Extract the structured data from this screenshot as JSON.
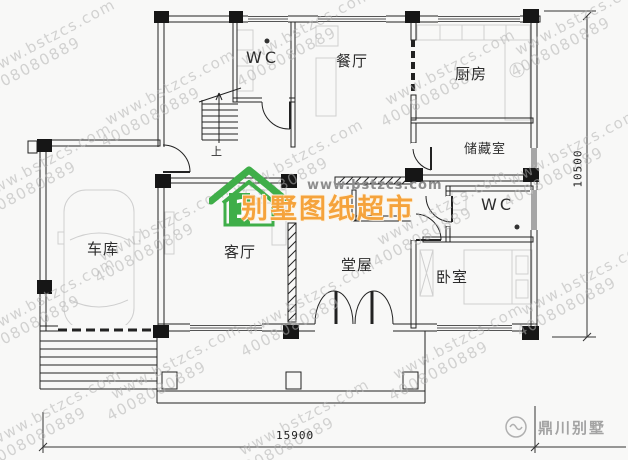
{
  "watermark": {
    "site": "www.bstzcs.com",
    "phone": "4008080889"
  },
  "rooms": {
    "wc_top": "WC",
    "dining": "餐厅",
    "kitchen": "厨房",
    "storage": "储藏室",
    "wc_right": "WC",
    "garage": "车库",
    "living": "客厅",
    "hall": "堂屋",
    "bedroom": "卧室"
  },
  "stairs": {
    "up_label": "上"
  },
  "dimensions": {
    "width_label": "15900",
    "height_label": "10500"
  },
  "center_logo": {
    "site": "www.bstzcs.com",
    "title": "别墅图纸超市",
    "house_number": "1"
  },
  "corner_logo": {
    "name": "鼎川别墅"
  },
  "colors": {
    "line": "#1f1f1f",
    "accent_green": "#3fae49",
    "accent_orange": "#f5a33c",
    "watermark_gray": "#b2b2b2"
  }
}
